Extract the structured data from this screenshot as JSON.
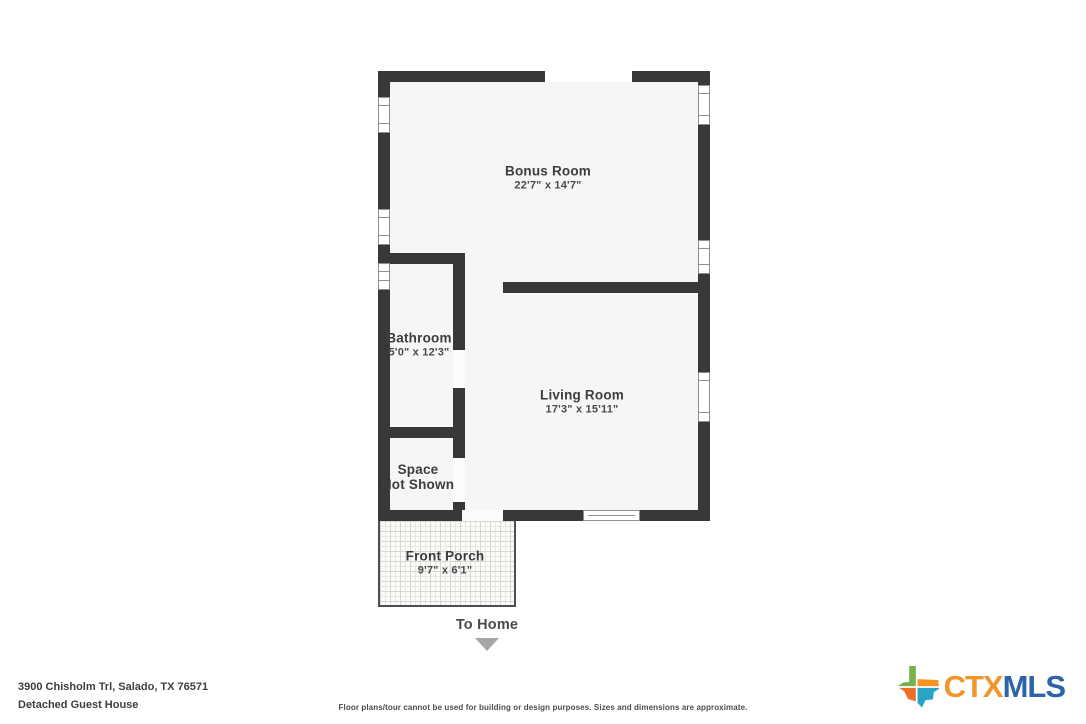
{
  "plan": {
    "rooms": {
      "bonus": {
        "name": "Bonus Room",
        "dims": "22'7\" x 14'7\""
      },
      "bathroom": {
        "name": "Bathroom",
        "dims": "5'0\" x 12'3\""
      },
      "living": {
        "name": "Living Room",
        "dims": "17'3\" x 15'11\""
      },
      "space": {
        "line1": "Space",
        "line2": "Not Shown"
      },
      "porch": {
        "name": "Front Porch",
        "dims": "9'7\" x 6'1\""
      }
    },
    "to_home_label": "To Home"
  },
  "footer": {
    "address": "3900 Chisholm Trl, Salado, TX 76571",
    "subtitle": "Detached Guest House",
    "disclaimer": "Floor plans/tour cannot be used for building or design purposes. Sizes and dimensions are approximate."
  },
  "logo": {
    "ctx": "CTX",
    "mls": "MLS"
  },
  "icons": {
    "to_home_arrow": "triangle-down",
    "logo_icon": "texas-state"
  },
  "colors": {
    "wall": "#383838",
    "room_fill": "#f6f6f4",
    "label_text": "#3d3d3d",
    "arrow_gray": "#a6a6a6",
    "logo_ctx": "#F2962B",
    "logo_mls": "#2B64A9",
    "logo_green": "#74B44A",
    "logo_orange": "#F7941E",
    "logo_red_orange": "#EC6E27",
    "logo_teal": "#2BA3C4"
  }
}
